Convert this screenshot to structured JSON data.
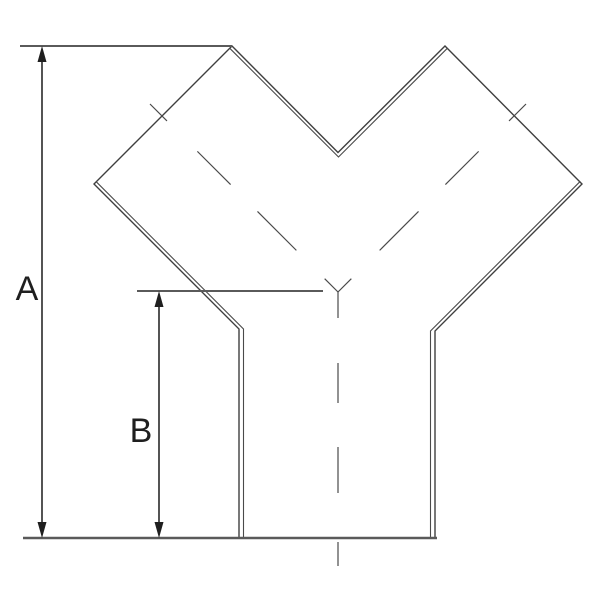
{
  "labels": {
    "dim_a": "A",
    "dim_b": "B"
  },
  "colors": {
    "background": "#ffffff",
    "outline": "#3f3f3f",
    "wall_line": "#4a4a4a",
    "centerline": "#4a4a4a",
    "dimension_line": "#2a2a2a",
    "extension_line": "#5a5a5a",
    "ground_line": "#5a5a5a",
    "arrow_fill": "#1f1f1f",
    "label_text": "#1f1f1f"
  }
}
